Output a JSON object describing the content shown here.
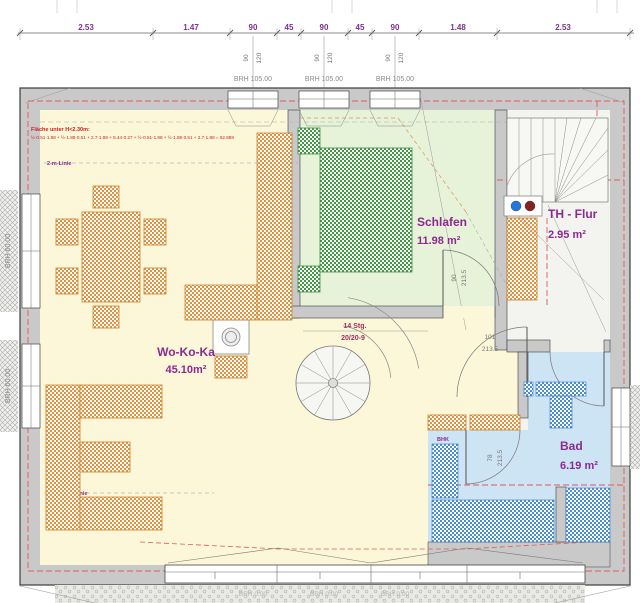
{
  "drawing": {
    "dim_chain": [
      "2.53",
      "1.47",
      "90",
      "45",
      "90",
      "45",
      "90",
      "1.48",
      "2.53"
    ],
    "axis_pair": {
      "a": "90",
      "b": "120"
    },
    "top_brh": "BRH 105.00",
    "left_brh": "BRH 60.00",
    "bottom_brh": "BRH 0.00",
    "rooms": {
      "wokoka": {
        "name": "Wo-Ko-Ka",
        "area": "45.10m²"
      },
      "schlafen": {
        "name": "Schlafen",
        "area": "11.98 m²"
      },
      "th_flur": {
        "name": "TH - Flur",
        "area": "2.95 m²"
      },
      "bad": {
        "name": "Bad",
        "area": "6.19 m²"
      }
    },
    "stair": {
      "line1": "14 Stg.",
      "line2": "20/20-9"
    },
    "doors": {
      "schlafen": {
        "w": "90",
        "h": "213.5"
      },
      "flur": {
        "w": "101",
        "h": "213.5"
      },
      "bad": {
        "w": "78",
        "h": "213.5"
      }
    },
    "notes": {
      "area_title": "Fläche unter H<2.30m:",
      "area_formula": "½·0.51·1.88 + ½·1.88·0.51 + 2.7·1.88 + 5.44·0.27 + ½·0.51·1.88 + ½·1.88·0.51 + 2.7·1.88 = 62.888",
      "two_m": "2-m-Linie",
      "bhk": "BHK"
    },
    "colors": {
      "wall": "#c9c9c9",
      "floor_yellow": "#fbf7d8",
      "floor_green": "#e6f3d9",
      "floor_blue": "#cde4f5",
      "hatch_orange": "#e5913c",
      "hatch_green": "#419a41",
      "hatch_blue": "#4a8fd2",
      "label_purple": "#8b2a8f",
      "roof_dash_red": "#e05a5a"
    }
  }
}
